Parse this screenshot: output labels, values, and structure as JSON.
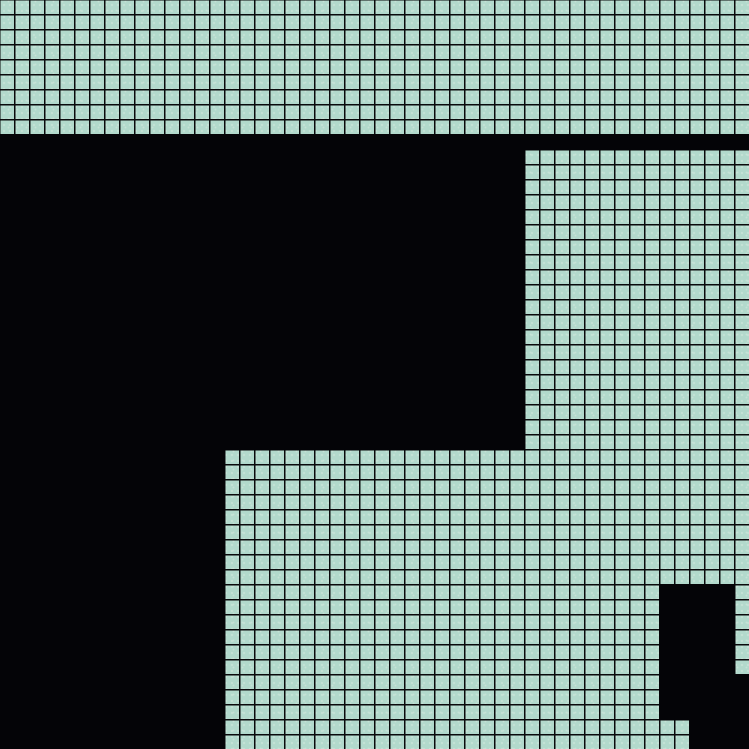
{
  "canvas": {
    "width": 749,
    "height": 749
  },
  "grid": {
    "cell_size_px": 15,
    "line_width_px": 1.6,
    "line_offset_px": 14,
    "cell_color": "#b2d9cc",
    "line_color": "#0a0a0c",
    "speckle_color": "#c5e2d6",
    "black_color": "#040407"
  },
  "black_regions": [
    {
      "id": "divider-band",
      "x": 0,
      "y": 134,
      "w": 749,
      "h": 16
    },
    {
      "id": "upper-left-block",
      "x": 0,
      "y": 134,
      "w": 525,
      "h": 316
    },
    {
      "id": "lower-left-column",
      "x": 0,
      "y": 449,
      "w": 225,
      "h": 300
    },
    {
      "id": "bottom-right-upper",
      "x": 659,
      "y": 584,
      "w": 76,
      "h": 91
    },
    {
      "id": "bottom-right-middle",
      "x": 659,
      "y": 674,
      "w": 90,
      "h": 46
    },
    {
      "id": "bottom-right-lower",
      "x": 689,
      "y": 719,
      "w": 60,
      "h": 30
    }
  ]
}
